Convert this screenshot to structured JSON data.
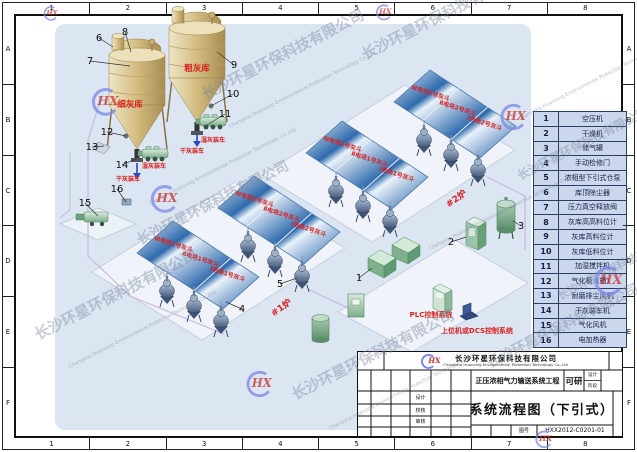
{
  "frame": {
    "cols": [
      "1",
      "2",
      "3",
      "4",
      "5",
      "6",
      "7",
      "8"
    ],
    "rows": [
      "A",
      "B",
      "C",
      "D",
      "E",
      "F"
    ]
  },
  "legend": {
    "rows": [
      {
        "num": "1",
        "label": "空压机"
      },
      {
        "num": "2",
        "label": "干燥机"
      },
      {
        "num": "3",
        "label": "储气罐"
      },
      {
        "num": "4",
        "label": "手动检修门"
      },
      {
        "num": "5",
        "label": "浓相型下引式仓泵"
      },
      {
        "num": "6",
        "label": "库顶除尘器"
      },
      {
        "num": "7",
        "label": "压力真空释放阀"
      },
      {
        "num": "8",
        "label": "灰库高高料位计"
      },
      {
        "num": "9",
        "label": "灰库高料位计"
      },
      {
        "num": "10",
        "label": "灰库低料位计"
      },
      {
        "num": "11",
        "label": "加湿搅拌机"
      },
      {
        "num": "12",
        "label": "气化板（槽）"
      },
      {
        "num": "13",
        "label": "耐磨排尘风机"
      },
      {
        "num": "14",
        "label": "干灰装车机"
      },
      {
        "num": "15",
        "label": "气化风机"
      },
      {
        "num": "16",
        "label": "电加热器"
      }
    ]
  },
  "title_block": {
    "logo": "HX",
    "company_cn": "长沙环星环保科技有限公司",
    "company_en": "Changsha Huanxing Environmental Protection Technology Co.,Ltd",
    "project": "正压浓相气力输送系统工程",
    "stage": "可研",
    "stage_small_top": "设计",
    "stage_small_bottom": "阶段",
    "cell_labels": [
      "设计",
      "校核",
      "审核"
    ],
    "drawing_no_label": "图号",
    "drawing_title": "系统流程图（下引式）",
    "drawing_no": "HXX2012-C0201-01"
  },
  "diagram": {
    "silo_fine": "细灰库",
    "silo_coarse": "粗灰库",
    "dry_load": "干灰装车",
    "wet_load": "湿灰装车",
    "boiler1": "#1炉",
    "boiler2": "#2炉",
    "plc": "PLC控制系统",
    "dcs": "上位机或DCS控制系统",
    "hopper_rows": [
      [
        "Ⅲ电场1号灰斗",
        "Ⅱ电场1号灰斗",
        "Ⅰ电场1号灰斗"
      ],
      [
        "Ⅲ电场2号灰斗",
        "Ⅱ电场2号灰斗",
        "Ⅰ电场2号灰斗"
      ]
    ],
    "callouts": [
      "1",
      "2",
      "3",
      "4",
      "5",
      "6",
      "7",
      "8",
      "9",
      "10",
      "11",
      "12",
      "13",
      "14",
      "15",
      "16"
    ]
  },
  "watermark": {
    "company_cn": "长沙环星环保科技有限公司",
    "company_en": "Changsha Huanxing Environmental Protection Technology Co.,Ltd",
    "logo": "HX"
  },
  "colors": {
    "label_red": "#d92222",
    "hopper_blue": "#2e6aac",
    "canvas_blue": "#dce6f2",
    "equipment_green": "#8cbf9a",
    "silo_tan": "#d3bc80"
  }
}
